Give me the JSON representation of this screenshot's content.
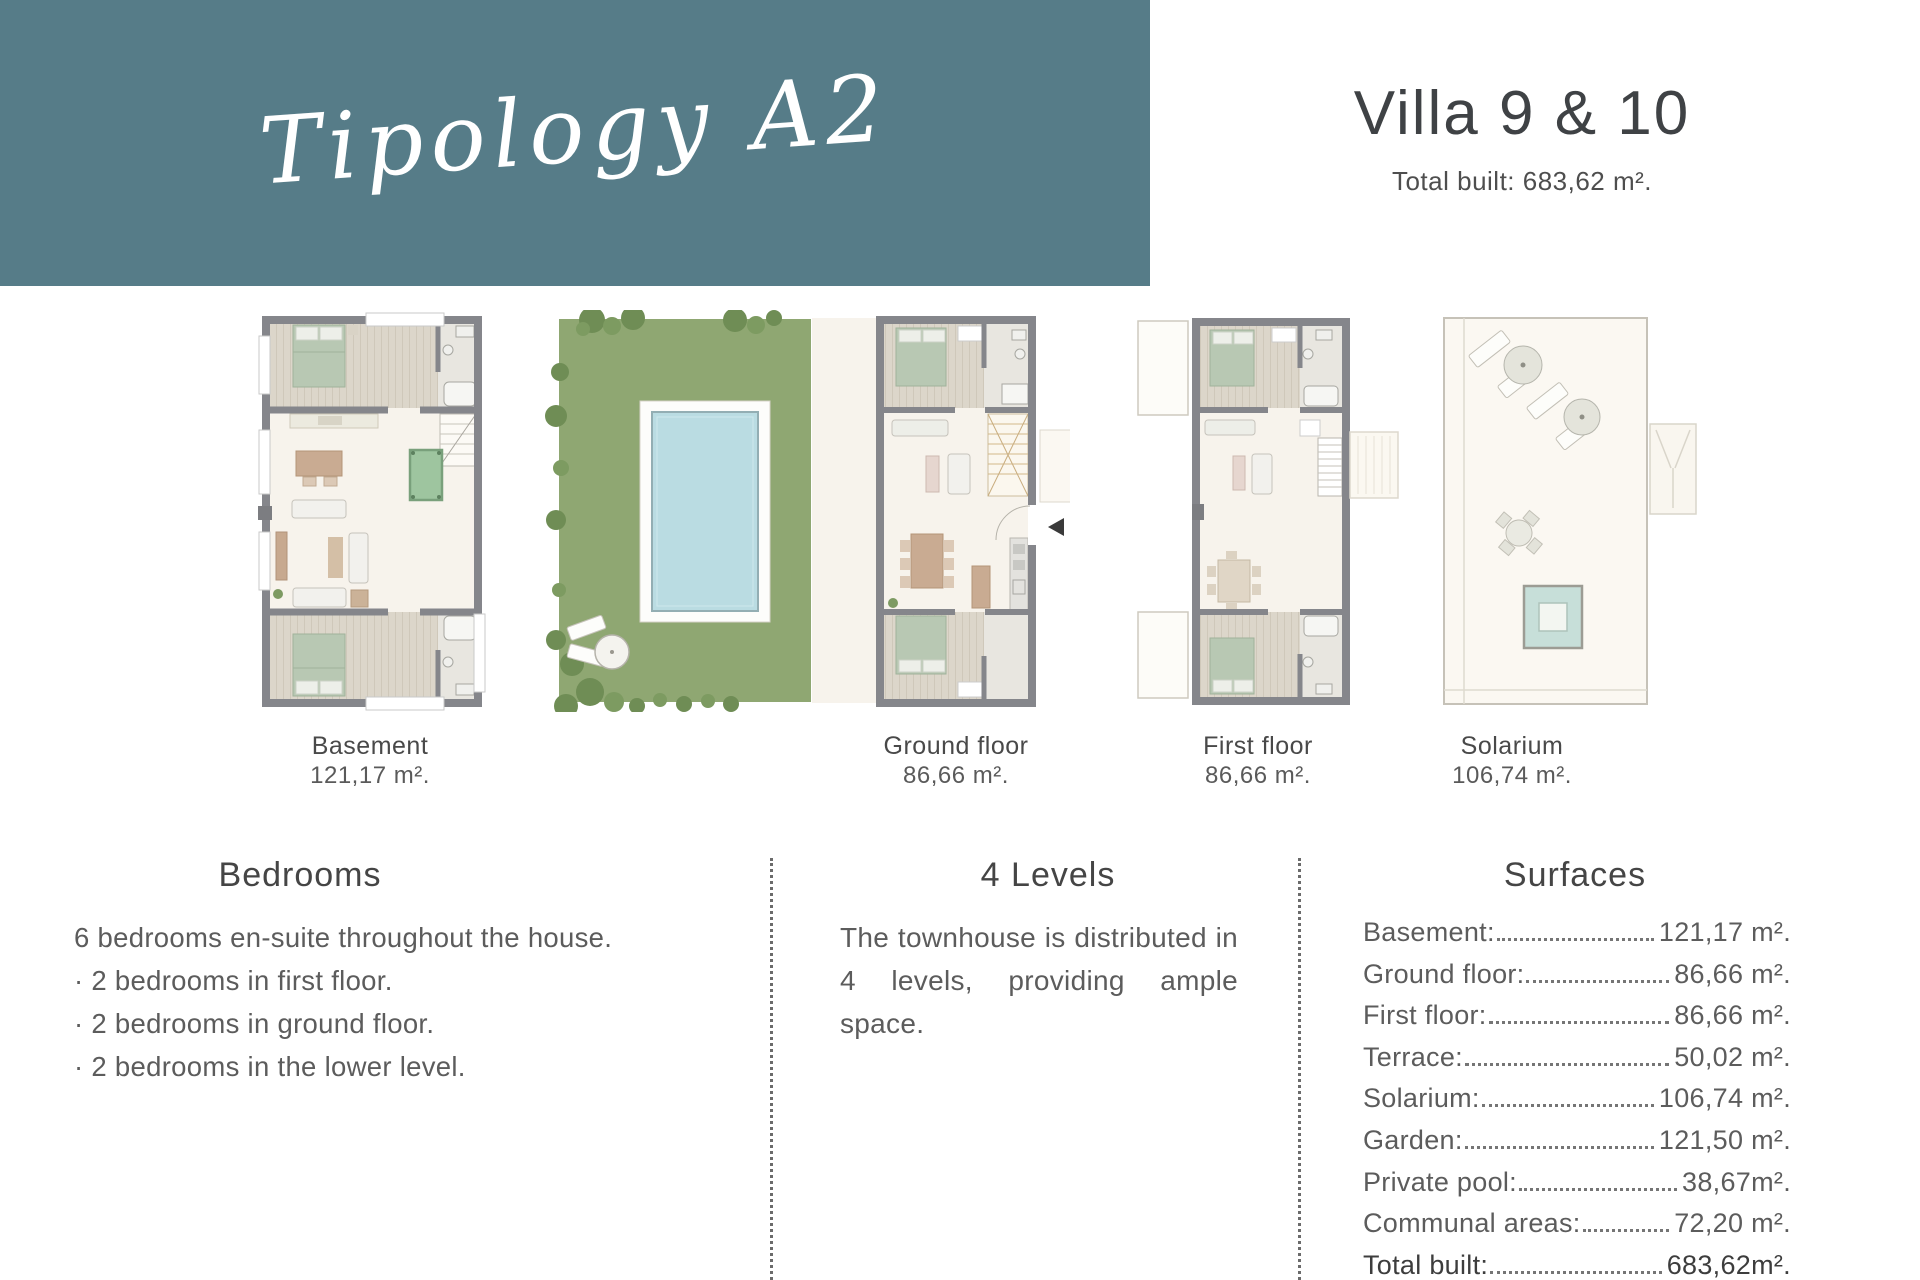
{
  "header": {
    "script_title": "Tipology A2",
    "villa_title": "Villa 9 & 10",
    "total_built": "Total built: 683,62 m²."
  },
  "floorplans": [
    {
      "name": "Basement",
      "area": "121,17 m²."
    },
    {
      "name": "Ground floor",
      "area": "86,66 m²."
    },
    {
      "name": "First floor",
      "area": "86,66 m²."
    },
    {
      "name": "Solarium",
      "area": "106,74 m²."
    }
  ],
  "sections": {
    "bedrooms": {
      "title": "Bedrooms",
      "intro": "6 bedrooms en-suite throughout the house.",
      "bullets": [
        "· 2 bedrooms in first floor.",
        "· 2 bedrooms in  ground floor.",
        "· 2 bedrooms in the lower level."
      ]
    },
    "levels": {
      "title": "4 Levels",
      "body": "The townhouse is distributed in 4 levels, providing ample space."
    },
    "surfaces": {
      "title": "Surfaces",
      "rows": [
        {
          "label": "Basement:",
          "value": "121,17 m²."
        },
        {
          "label": "Ground floor:",
          "value": "86,66 m²."
        },
        {
          "label": "First floor:",
          "value": "86,66 m²."
        },
        {
          "label": "Terrace:",
          "value": "50,02 m²."
        },
        {
          "label": "Solarium:",
          "value": "106,74 m²."
        },
        {
          "label": "Garden:",
          "value": "121,50 m²."
        },
        {
          "label": "Private pool:",
          "value": "38,67m²."
        },
        {
          "label": "Communal areas:",
          "value": "72,20 m²."
        },
        {
          "label": "Total built:",
          "value": "683,62m²."
        }
      ]
    }
  },
  "colors": {
    "header_band": "#567C88",
    "garden_green": "#8FA772",
    "pool_blue": "#BADCE2",
    "wall_gray": "#85868B",
    "wood_floor": "#DCD6CA",
    "living_cream": "#F7F3EC",
    "bed_green": "#B8C8B3",
    "title_text": "#3F4245",
    "body_text": "#5C5C5C"
  }
}
